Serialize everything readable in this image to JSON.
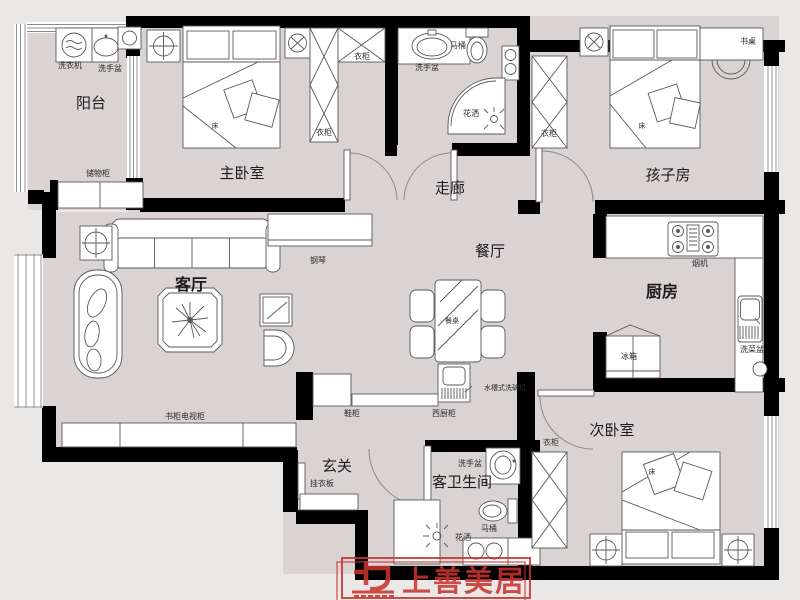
{
  "plan": {
    "rooms": {
      "balcony": "阳台",
      "master_bedroom": "主卧室",
      "corridor": "走廊",
      "kids_room": "孩子房",
      "living_room": "客厅",
      "dining_room": "餐厅",
      "kitchen": "厨房",
      "entry": "玄关",
      "guest_bathroom": "客卫生间",
      "second_bedroom": "次卧室"
    },
    "furniture": {
      "washing_machine": "洗衣机",
      "wash_basin": "洗手盆",
      "storage_cabinet": "储物柜",
      "bed": "床",
      "wardrobe": "衣柜",
      "desk": "书桌",
      "toilet": "马桶",
      "shower": "花洒",
      "piano": "钢琴",
      "dining_table": "餐桌",
      "sink_dishwasher": "水槽式洗碗机",
      "west_kitchen_cabinet": "西厨柜",
      "shoe_cabinet": "鞋柜",
      "coat_board": "挂衣板",
      "range_hood": "烟机",
      "vegetable_sink": "洗菜盆",
      "fridge": "冰箱",
      "tv_bookcase": "书柜电视柜"
    },
    "logo": {
      "brand": "上善美居"
    },
    "colors": {
      "floor": "#d9d3d3",
      "outside": "#eae7e7",
      "wall": "#000000",
      "logo_red": "#c9332e"
    }
  }
}
